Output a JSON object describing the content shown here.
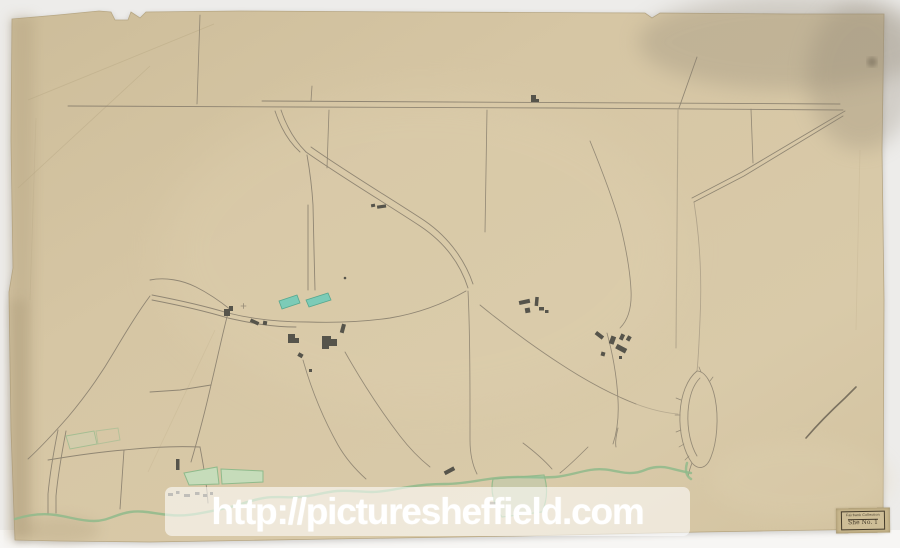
{
  "colors": {
    "bg": "#edecea",
    "below-strip": "#f7f6f4",
    "paper": "#d6c6a4",
    "paper-edge": "#b7a784",
    "ink": "#8d8371",
    "ink-dark": "#6b6354",
    "building": "#56544b",
    "green": "#8fba8b",
    "green-fill": "#c6dcba",
    "teal": "#7ccbb7",
    "teal-stroke": "#56a78e",
    "stain": "#968c79",
    "stamp-bg": "#c8b78d",
    "stamp-ink": "#443b2a",
    "watermark-text": "#ffffff"
  },
  "watermark": {
    "text": "http://picturesheffield.com"
  },
  "stamp": {
    "line1": "Fairbank Collection",
    "line2": "She No. 1"
  }
}
